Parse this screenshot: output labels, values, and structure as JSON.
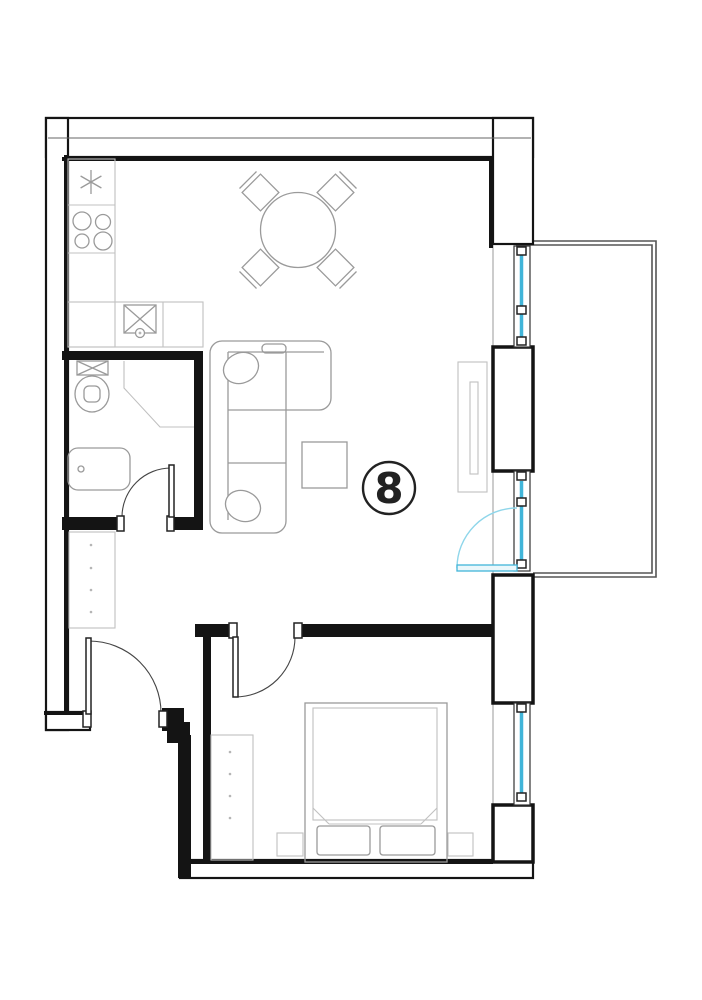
{
  "floorplan": {
    "unit_number": "8",
    "colors": {
      "wall": "#141414",
      "furniture": "#9a9a9a",
      "glass": "#41b5d9",
      "door_arc": "#8fd6ea",
      "balcony": "#555555",
      "background": "#ffffff"
    }
  }
}
